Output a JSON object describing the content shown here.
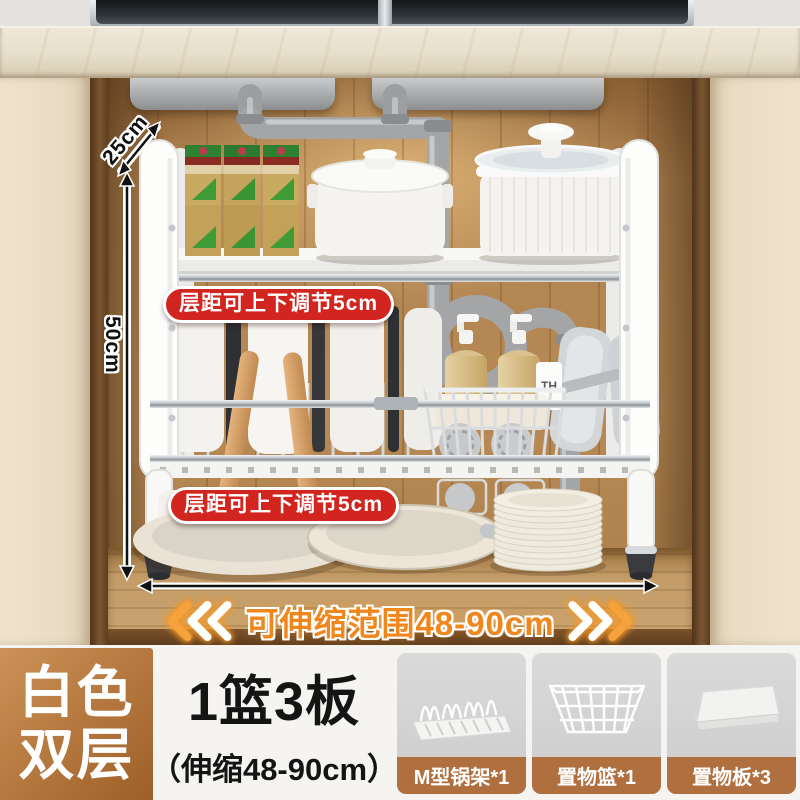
{
  "annotations": {
    "depth": "25cm",
    "height": "50cm",
    "tier_badge_top": "层距可上下调节5cm",
    "tier_badge_bottom": "层距可上下调节5cm",
    "range": "可伸缩范围48-90cm"
  },
  "scene": {
    "bottle_label": "TH",
    "icons": {
      "left_chevrons": "triple-chevron-left",
      "right_chevrons": "triple-chevron-right",
      "depth_arrow": "diagonal-double-arrow",
      "height_arrow": "vertical-double-arrow",
      "width_arrow": "horizontal-double-arrow"
    }
  },
  "info": {
    "variant_line1": "白色",
    "variant_line2": "双层",
    "title": "1篮3板",
    "subtitle": "（伸缩48-90cm）",
    "thumbs": [
      {
        "label": "M型锅架*1",
        "icon": "m-pot-rack-icon"
      },
      {
        "label": "置物篮*1",
        "icon": "storage-basket-icon"
      },
      {
        "label": "置物板*3",
        "icon": "storage-board-icon"
      }
    ]
  },
  "colors": {
    "badge_red": "#d2251f",
    "accent_orange": "#f0871c",
    "thumb_label_brown": "#b06f3e",
    "variant_grad_start": "#cd9257",
    "variant_grad_end": "#9d5f26"
  }
}
